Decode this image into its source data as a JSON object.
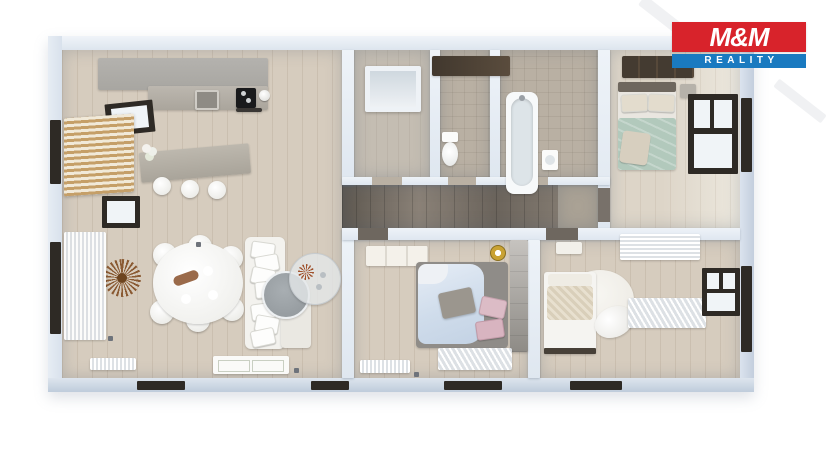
{
  "logo": {
    "brand": "M&M",
    "tagline": "REALITY",
    "colors": {
      "red": "#d8232b",
      "blue": "#1a7ac0",
      "text": "#ffffff"
    }
  },
  "floor_plan": {
    "description": "3D top-down render of a three-bedroom apartment with open-plan living room and kitchen",
    "palette": {
      "wall": "#dfe7f0",
      "wall-face": "#eef3f8",
      "wall-deep": "#c2cedd",
      "floor-wood": "#d6ccbe",
      "floor-pale": "#ddd5c8",
      "floor-tile": "#b9b0a3",
      "floor-entry": "#c4bdb2",
      "floor-corridor": "#7c756b",
      "accent-wood": "#c59f68",
      "window-frame": "#2e2a25"
    },
    "rooms": [
      {
        "id": "living-room-kitchen",
        "furniture": [
          "kitchen-counter",
          "sink",
          "cooktop",
          "kitchen-island",
          "bar-stools",
          "wood-slat-wall",
          "balcony-door",
          "wall-clock",
          "curtains",
          "radiator",
          "dining-table",
          "dining-chairs",
          "sofa",
          "coffee-table",
          "glass-side-table",
          "door-mats"
        ]
      },
      {
        "id": "entry-hall",
        "furniture": [
          "glass-entry-door",
          "built-in-wardrobe"
        ]
      },
      {
        "id": "toilet-room",
        "furniture": [
          "toilet"
        ]
      },
      {
        "id": "bathroom",
        "furniture": [
          "bathtub",
          "wash-basin",
          "dark-vanity"
        ]
      },
      {
        "id": "bedroom-top-right",
        "furniture": [
          "double-bed",
          "wardrobe",
          "nightstand",
          "window"
        ]
      },
      {
        "id": "corridor",
        "furniture": []
      },
      {
        "id": "bedroom-bottom-middle",
        "furniture": [
          "double-bed",
          "dresser",
          "wardrobe",
          "ceiling-lamp",
          "sheer-curtains"
        ]
      },
      {
        "id": "bedroom-bottom-right",
        "furniture": [
          "bed",
          "round-rug",
          "armchair",
          "nightstand",
          "sheer-curtains",
          "window"
        ]
      }
    ]
  }
}
